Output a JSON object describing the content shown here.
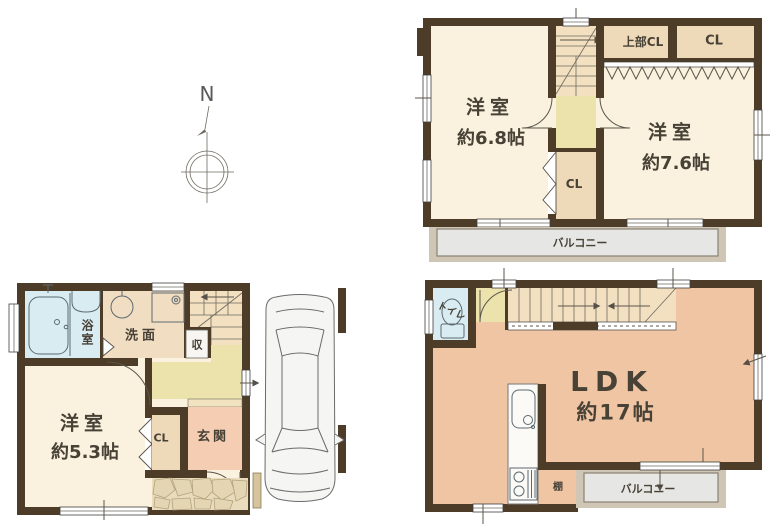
{
  "compass": {
    "north": "N"
  },
  "floor2": {
    "room1": {
      "name": "洋室",
      "size": "約6.8帖"
    },
    "room2": {
      "name": "洋室",
      "size": "約7.6帖"
    },
    "upper_closet": "上部CL",
    "closet_right": "CL",
    "closet_mid": "CL",
    "balcony": "バルコニー"
  },
  "floor1": {
    "bathroom": "浴室",
    "washroom": "洗面",
    "storage": "収",
    "room": {
      "name": "洋室",
      "size": "約5.3帖"
    },
    "closet": "CL",
    "entrance": "玄関"
  },
  "ldk": {
    "toilet": "トイレ",
    "room": {
      "name": "LDK",
      "size": "約17帖"
    },
    "shelf": "棚",
    "balcony": "バルコニー"
  },
  "colors": {
    "wall": "#4d3c28",
    "room_cream": "#faf1de",
    "closet_tan": "#eed9b8",
    "stair_tan": "#f3e0c0",
    "hall_yellow": "#ece2ac",
    "ldk_peach": "#f0c5a3",
    "entrance_peach": "#f5cdb2",
    "wet_blue": "#d8ecf2",
    "balcony_gray": "#e6e6e4",
    "stone_beige": "#e9dcbd"
  }
}
